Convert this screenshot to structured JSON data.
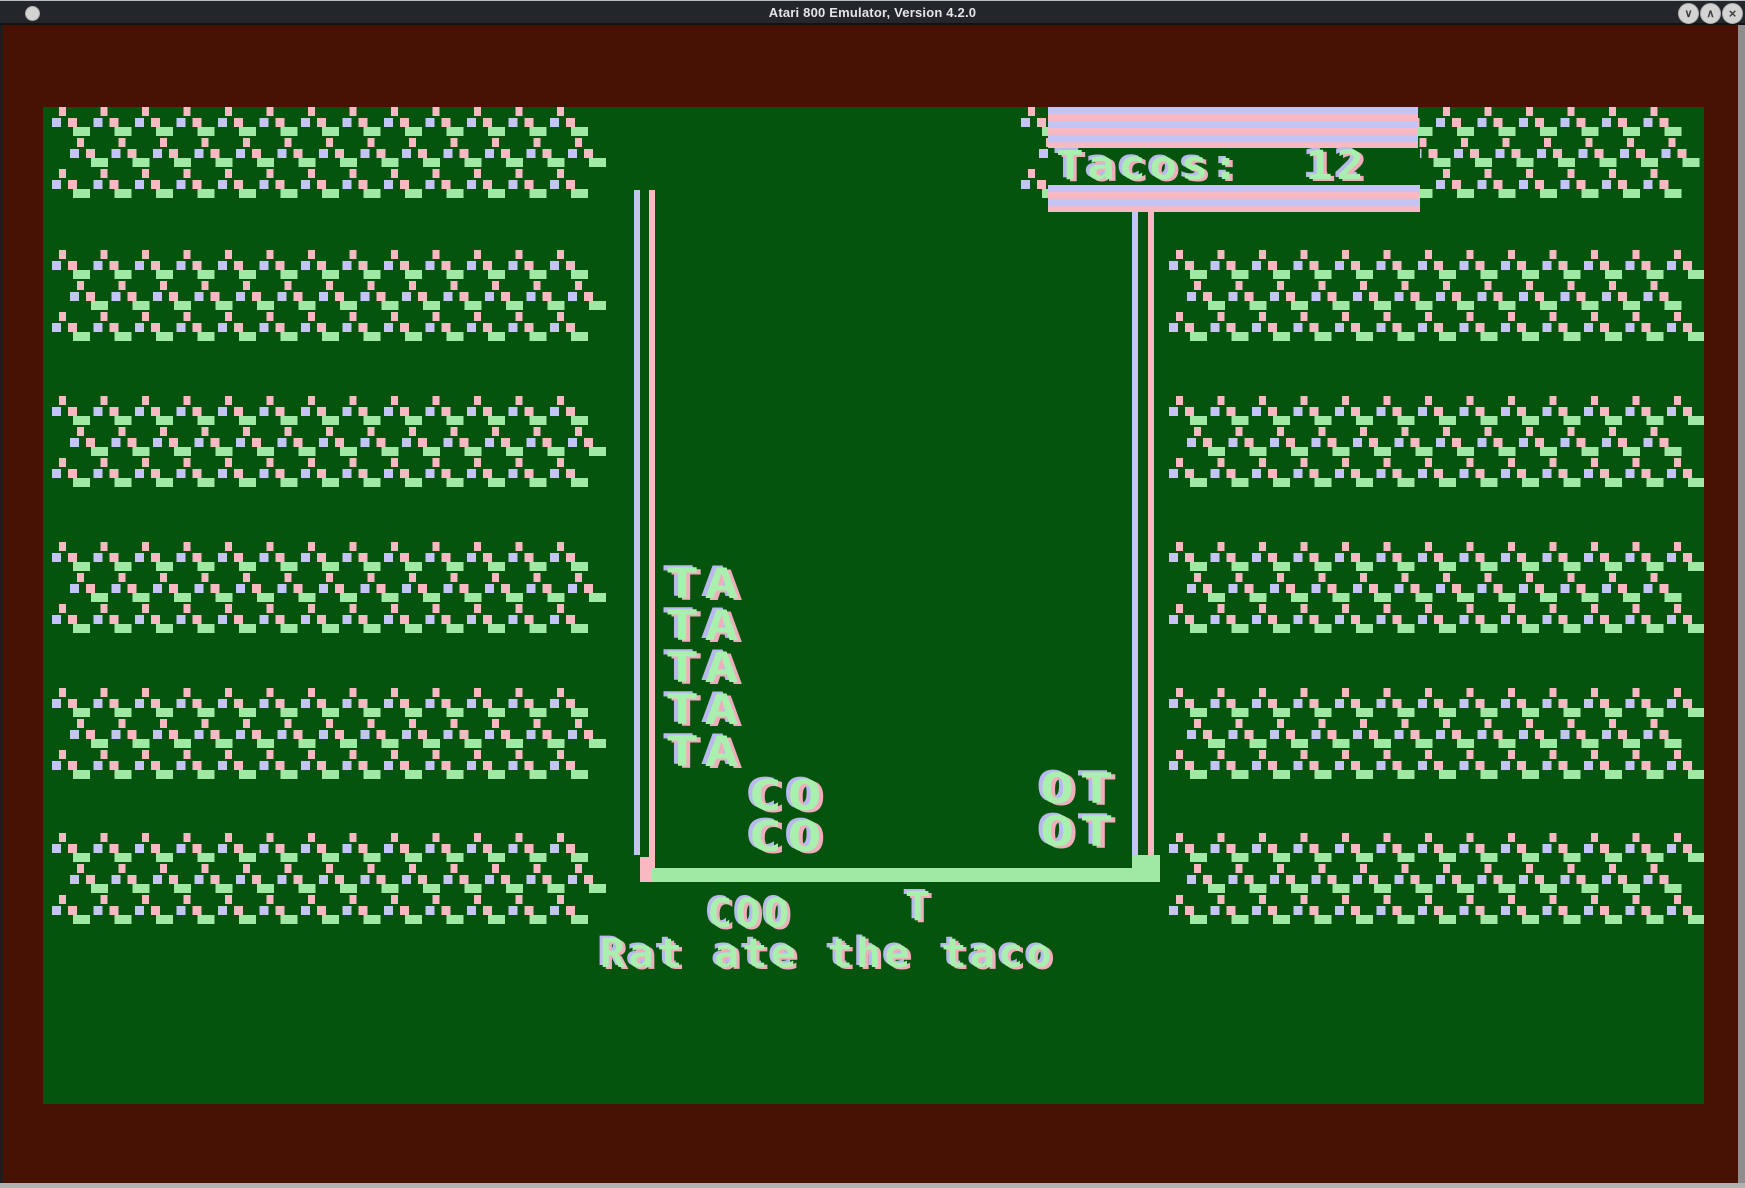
{
  "window": {
    "title": "Atari 800 Emulator, Version 4.2.0",
    "controls": {
      "minimize_glyph": "∨",
      "maximize_glyph": "∧",
      "close_glyph": "×"
    }
  },
  "colors": {
    "screen_green": "#05540e",
    "border_maroon": "#471103",
    "pattern_pink": "#f8b9c3",
    "pattern_lavender": "#c5c5f5",
    "pattern_green": "#9fe9a2",
    "text_green": "#a9efae",
    "titlebar_gray": "#23272b"
  },
  "game": {
    "score_display": "Tacos:  12",
    "pieces": {
      "ta_stack": [
        "TA",
        "TA",
        "TA",
        "TA",
        "TA"
      ],
      "co_stack": [
        "CO",
        "CO"
      ],
      "ot_stack": [
        "OT",
        "OT"
      ]
    },
    "falling_letters": "COO",
    "falling_single": "T",
    "message": "Rat ate the taco"
  }
}
